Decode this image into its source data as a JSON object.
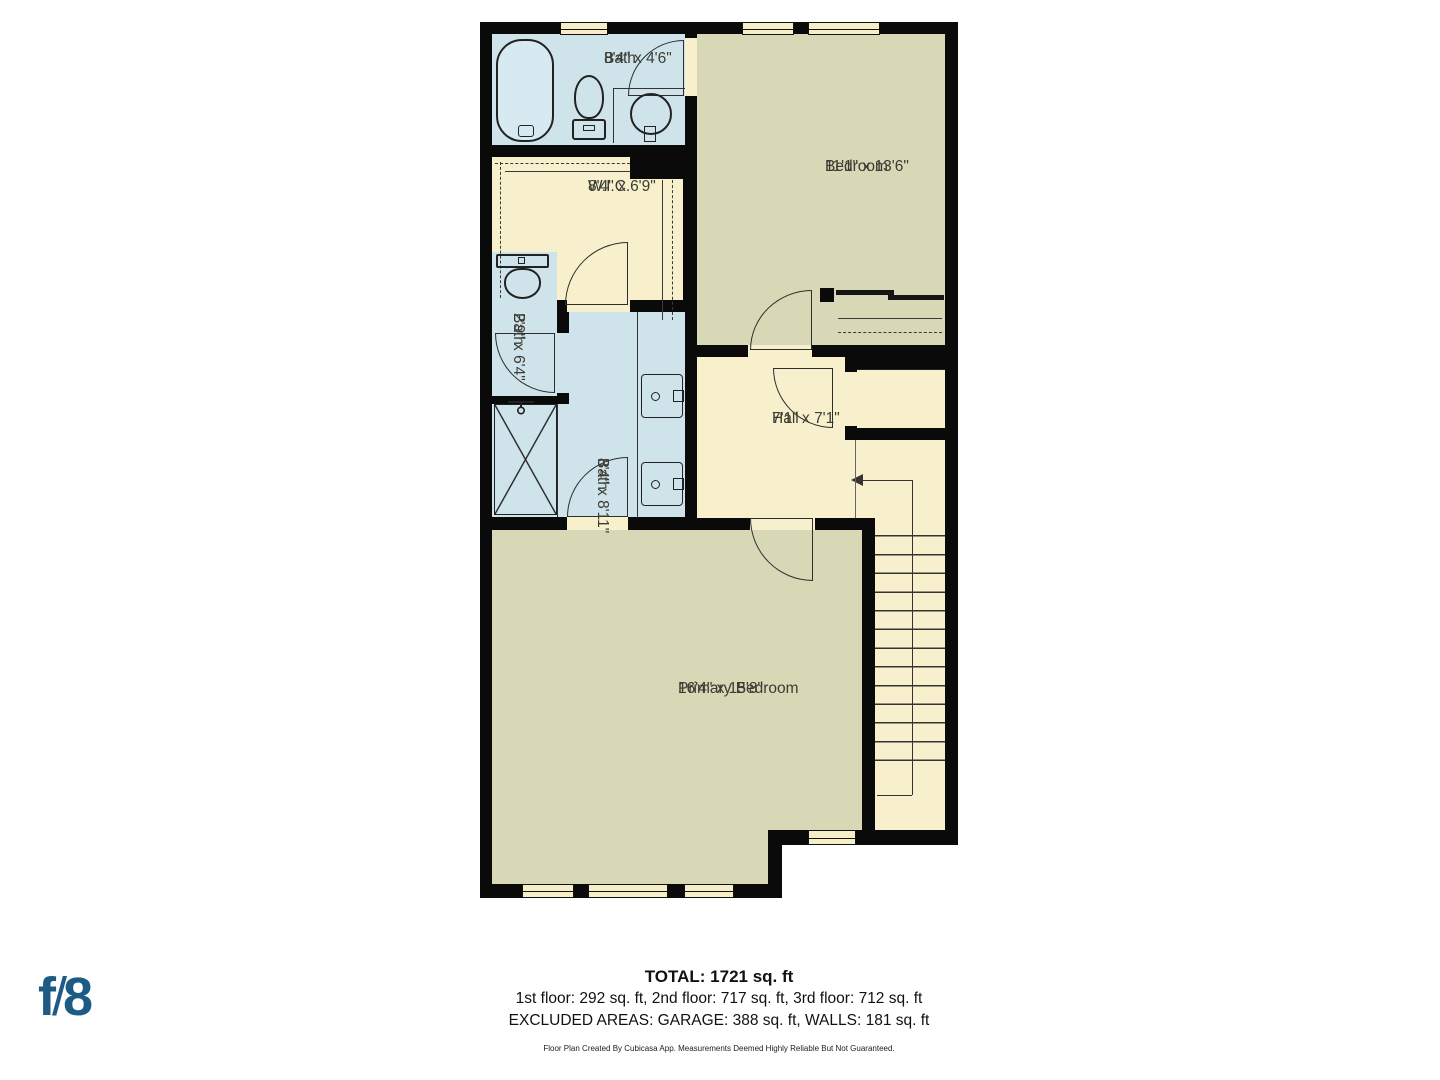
{
  "plan": {
    "rooms": {
      "bath_top": {
        "name": "Bath",
        "dims": "8'4\" x 4'6\""
      },
      "bedroom": {
        "name": "Bedroom",
        "dims": "11'1\" x 13'6\""
      },
      "wic": {
        "name": "W.I.C.",
        "dims": "8'4\" x 6'9\""
      },
      "bath_small": {
        "name": "Bath",
        "dims": "2'9\" x 6'4\""
      },
      "bath_main": {
        "name": "Bath",
        "dims": "8'4\" x 8'11\""
      },
      "hall": {
        "name": "Hall",
        "dims": "7'1\" x 7'1\""
      },
      "primary_bedroom": {
        "name": "Primary Bedroom",
        "dims": "16'4\" x 15'8\""
      }
    },
    "colors": {
      "wall": "#0a0a0a",
      "room_cream": "#f8f0cc",
      "room_blue": "#cfe3ea",
      "room_olive": "#d8d7b6",
      "background": "#ffffff"
    }
  },
  "branding": {
    "logo": {
      "f": "f",
      "slash": "/",
      "eight": "8"
    },
    "logo_color": "#1d5b85"
  },
  "summary": {
    "total": "TOTAL: 1721 sq. ft",
    "floors": "1st floor: 292 sq. ft, 2nd floor: 717 sq. ft, 3rd floor: 712 sq. ft",
    "excluded": "EXCLUDED AREAS: GARAGE: 388 sq. ft, WALLS: 181 sq. ft",
    "disclaimer": "Floor Plan Created By Cubicasa App. Measurements Deemed Highly Reliable But Not Guaranteed."
  }
}
